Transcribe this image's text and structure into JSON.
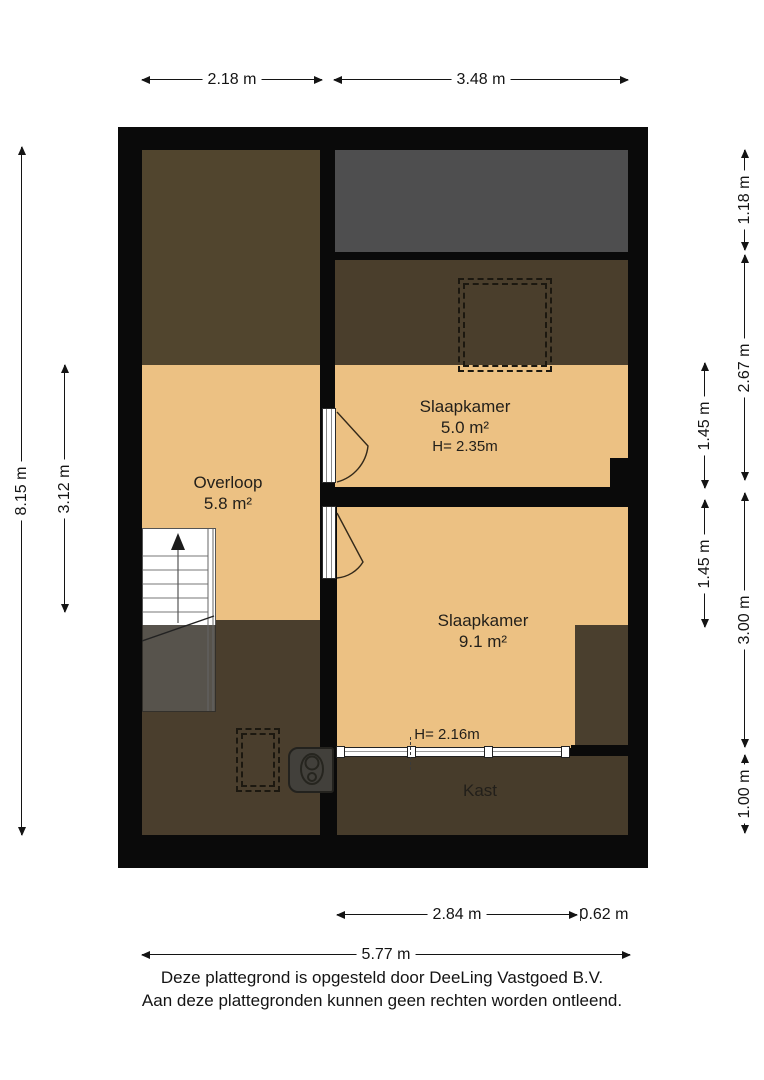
{
  "footer": {
    "line1": "Deze plattegrond is opgesteld door DeeLing Vastgoed B.V.",
    "line2": "Aan deze plattegronden kunnen geen rechten worden ontleend."
  },
  "colors": {
    "wall": "#0a0a0a",
    "floor_tan": "#ecc183",
    "roof_void_gray": "#4e4e4f",
    "low_headroom_brown": "#4a3e2d",
    "landing_top_brown": "#51452e",
    "bed5_brown": "#4a3e2c",
    "notch_brown": "#4a3f2e",
    "kast_brown": "#473c2b",
    "stair_under_roof": "#57534c"
  },
  "labels": [
    {
      "name": "room-label-overloop",
      "x": 228,
      "y": 472,
      "lines": [
        {
          "t": "Overloop",
          "s": 17
        },
        {
          "t": "5.8 m²",
          "s": 17
        }
      ]
    },
    {
      "name": "room-label-slaapkamer-5",
      "x": 465,
      "y": 396,
      "lines": [
        {
          "t": "Slaapkamer",
          "s": 17
        },
        {
          "t": "5.0 m²",
          "s": 17
        },
        {
          "t": "H= 2.35m",
          "s": 15
        }
      ]
    },
    {
      "name": "room-label-slaapkamer-9",
      "x": 483,
      "y": 610,
      "lines": [
        {
          "t": "Slaapkamer",
          "s": 17
        },
        {
          "t": "9.1 m²",
          "s": 17
        }
      ]
    },
    {
      "name": "height-label-slaapkamer-9",
      "x": 447,
      "y": 726,
      "lines": [
        {
          "t": "H= 2.16m",
          "s": 15
        }
      ]
    },
    {
      "name": "room-label-kast",
      "x": 480,
      "y": 780,
      "lines": [
        {
          "t": "Kast",
          "s": 17
        }
      ]
    }
  ],
  "dimensions": {
    "horizontal": [
      {
        "label": "2.18 m",
        "x1": 142,
        "x2": 322,
        "y": 80
      },
      {
        "label": "3.48 m",
        "x1": 334,
        "x2": 628,
        "y": 80
      },
      {
        "label": "2.84 m",
        "x1": 337,
        "x2": 577,
        "y": 915
      },
      {
        "label": "5.77 m",
        "x1": 142,
        "x2": 630,
        "y": 955
      }
    ],
    "vertical": [
      {
        "label": "8.15 m",
        "x": 22,
        "y1": 147,
        "y2": 835
      },
      {
        "label": "3.12 m",
        "x": 65,
        "y1": 365,
        "y2": 612
      },
      {
        "label": "1.45 m",
        "x": 705,
        "y1": 363,
        "y2": 488
      },
      {
        "label": "1.45 m",
        "x": 705,
        "y1": 500,
        "y2": 627
      },
      {
        "label": "1.18 m",
        "x": 745,
        "y1": 150,
        "y2": 250
      },
      {
        "label": "2.67 m",
        "x": 745,
        "y1": 255,
        "y2": 480
      },
      {
        "label": "3.00 m",
        "x": 745,
        "y1": 493,
        "y2": 747
      },
      {
        "label": "1.00 m",
        "x": 745,
        "y1": 755,
        "y2": 833
      }
    ],
    "free_labels": [
      {
        "label": "0.62 m",
        "x": 604,
        "y": 915
      }
    ],
    "ticks": [
      {
        "x": 580,
        "y1": 909,
        "y2": 921,
        "style": "solid"
      },
      {
        "x": 410,
        "y1": 737,
        "y2": 770,
        "style": "dashed"
      }
    ]
  }
}
